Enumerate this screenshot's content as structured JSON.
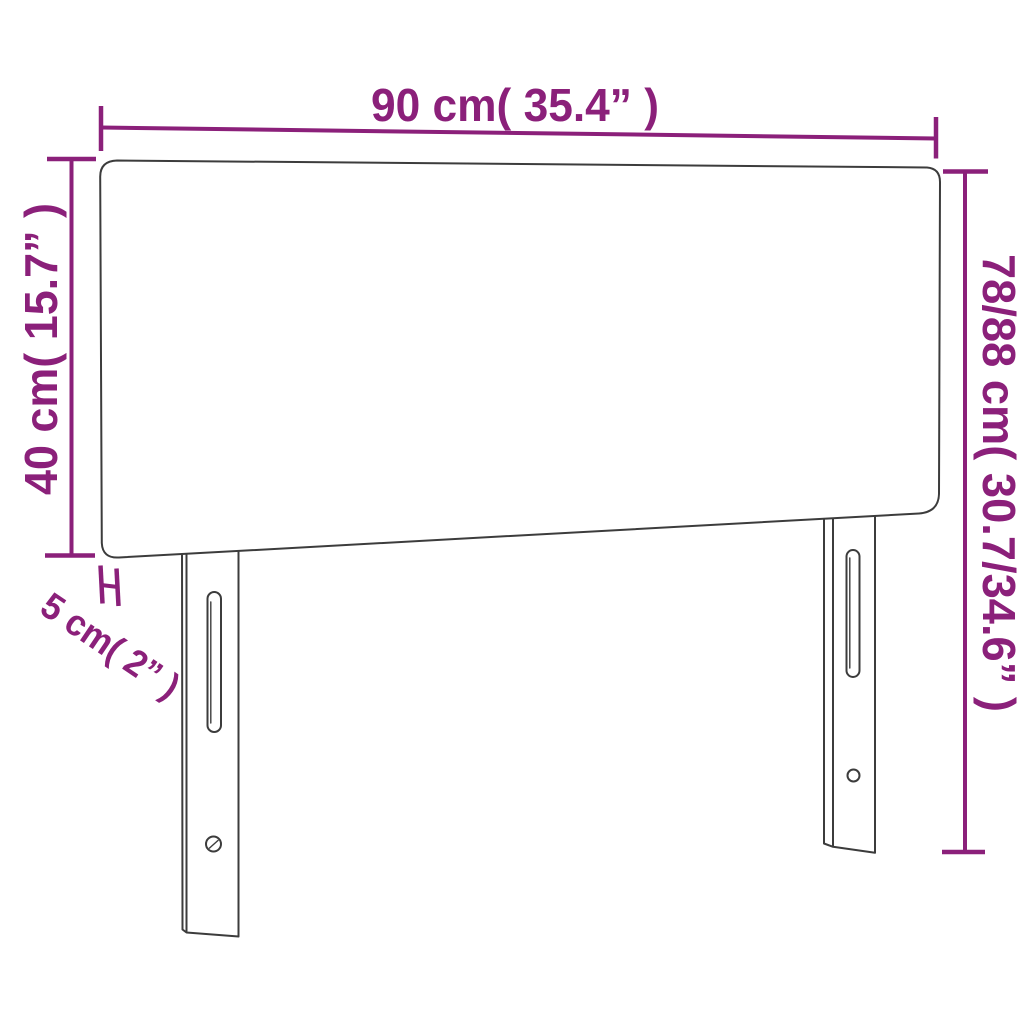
{
  "page": {
    "background": "#FFFFFF"
  },
  "colors": {
    "dimension_annotation": "#8B207A",
    "product_outline": "#3C3C3C"
  },
  "diagram": {
    "product": "headboard",
    "dimension_labels": {
      "width": "90 cm( 35.4” )",
      "left_height": "40 cm( 15.7” )",
      "right_height": "78/88 cm( 30.7/34.6” )",
      "thickness": "5 cm( 2” )"
    }
  }
}
